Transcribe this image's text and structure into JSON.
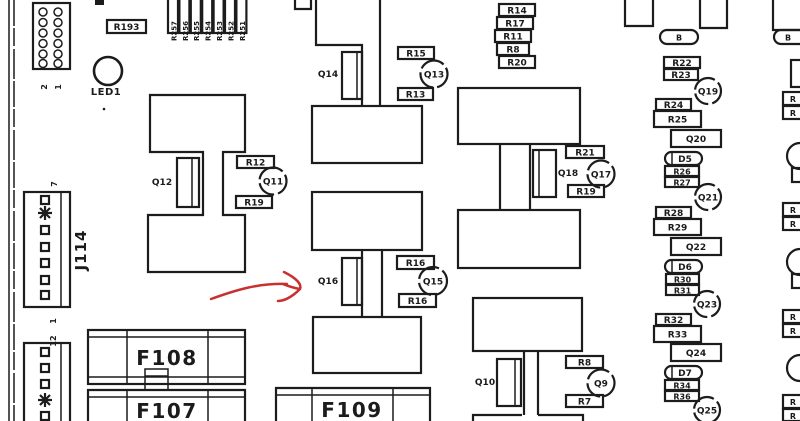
{
  "colors": {
    "ink": "#1b1b1b",
    "paper": "#ffffff",
    "annotation_red": "#c93030"
  },
  "annotation": {
    "type": "hand-drawn red arrow",
    "points_to": "Q16"
  },
  "parts": {
    "led1": "LED1",
    "r193": "R193",
    "resistor_bank": [
      "R257",
      "R256",
      "R255",
      "R254",
      "R253",
      "R252",
      "R251"
    ],
    "resistor_stack": [
      "R14",
      "R17",
      "R11",
      "R8",
      "R20"
    ],
    "pills": [
      "B",
      "B"
    ],
    "blocks": [
      {
        "transistor": "Q12",
        "resistor_top": "R12",
        "transistor_circle": "Q11",
        "resistor_bottom": "R19"
      },
      {
        "transistor": "Q14",
        "resistor_top": "R15",
        "transistor_circle": "Q13",
        "resistor_bottom": "R13"
      },
      {
        "transistor": "Q16",
        "resistor_top": "R16",
        "transistor_circle": "Q15",
        "resistor_bottom": "R16"
      },
      {
        "transistor": "Q18",
        "resistor_top": "R21",
        "transistor_circle": "Q17",
        "resistor_bottom": "R19"
      },
      {
        "transistor": "Q10",
        "resistor_top": "R8",
        "transistor_circle": "Q9",
        "resistor_bottom": "R7"
      }
    ],
    "right_column": [
      "R22",
      "R23",
      "Q19",
      "R24",
      "R25",
      "Q20",
      "D5",
      "R26",
      "R27",
      "Q21",
      "R28",
      "R29",
      "Q22",
      "D6",
      "R30",
      "R31",
      "Q23",
      "R32",
      "R33",
      "Q24",
      "D7",
      "R34",
      "R36",
      "Q25"
    ],
    "edge_fragments": [
      "R",
      "R",
      "R",
      "R",
      "R",
      "R",
      "R",
      "R"
    ],
    "fuses": [
      "F108",
      "F107",
      "F109"
    ],
    "connectors": {
      "j114": "J114",
      "j114_pin_top": "7",
      "j114_pin_bottom": "1",
      "bottom_pin_top": "12",
      "header_pin_labels": [
        "2",
        "1"
      ]
    }
  }
}
